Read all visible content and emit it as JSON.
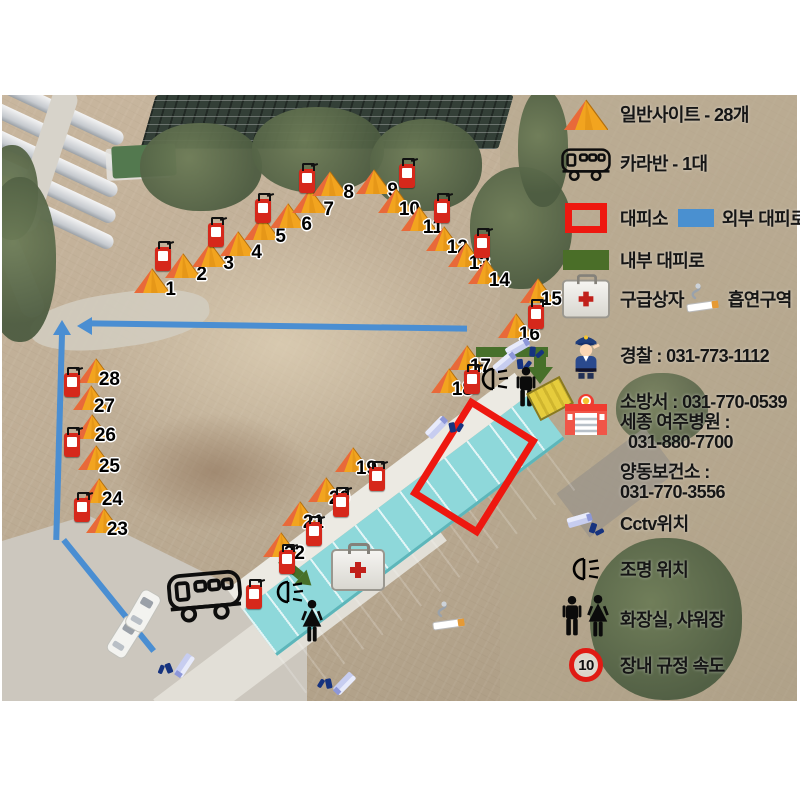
{
  "legend": {
    "site_label": "일반사이트 - 28개",
    "caravan_label": "카라반 - 1대",
    "shelter_label": "대피소",
    "external_route_label": "외부 대피로",
    "internal_route_label": "내부 대피로",
    "first_aid_label": "구급상자",
    "smoking_label": "흡연구역",
    "police_phone_label": "경찰 : 031-773-1112",
    "fire_phone_label": "소방서 : 031-770-0539",
    "hospital_name_label": "세종 여주병원 :",
    "hospital_phone": "031-880-7700",
    "health_center_label": "양동보건소 :",
    "health_center_phone": "031-770-3556",
    "cctv_label": "Cctv위치",
    "light_label": "조명 위치",
    "restroom_label": "화장실, 샤워장",
    "speed_label": "장내 규정 속도",
    "speed_value": "10"
  },
  "colors": {
    "external_route": "#4a8ed2",
    "internal_route": "#47702a",
    "shelter_outline": "#ee1810",
    "tent_body": "#f2a41f",
    "tent_flap": "#e8693a",
    "extinguisher": "#d6281b",
    "building_roof": "#8ed8da",
    "speed_circle": "#e01b14"
  },
  "map": {
    "tents": [
      {
        "n": "1",
        "x": 152,
        "y": 281
      },
      {
        "n": "2",
        "x": 183,
        "y": 266
      },
      {
        "n": "3",
        "x": 210,
        "y": 255
      },
      {
        "n": "4",
        "x": 238,
        "y": 244
      },
      {
        "n": "5",
        "x": 262,
        "y": 228
      },
      {
        "n": "6",
        "x": 288,
        "y": 216
      },
      {
        "n": "7",
        "x": 310,
        "y": 201
      },
      {
        "n": "8",
        "x": 330,
        "y": 184
      },
      {
        "n": "9",
        "x": 374,
        "y": 182
      },
      {
        "n": "10",
        "x": 396,
        "y": 201
      },
      {
        "n": "11",
        "x": 419,
        "y": 219
      },
      {
        "n": "12",
        "x": 444,
        "y": 239
      },
      {
        "n": "13",
        "x": 466,
        "y": 255
      },
      {
        "n": "14",
        "x": 486,
        "y": 272
      },
      {
        "n": "15",
        "x": 538,
        "y": 291
      },
      {
        "n": "16",
        "x": 516,
        "y": 326
      },
      {
        "n": "17",
        "x": 467,
        "y": 358
      },
      {
        "n": "18",
        "x": 449,
        "y": 381
      },
      {
        "n": "19",
        "x": 353,
        "y": 460
      },
      {
        "n": "20",
        "x": 326,
        "y": 490
      },
      {
        "n": "21",
        "x": 300,
        "y": 514
      },
      {
        "n": "22",
        "x": 281,
        "y": 545
      },
      {
        "n": "23",
        "x": 104,
        "y": 521
      },
      {
        "n": "24",
        "x": 99,
        "y": 491
      },
      {
        "n": "25",
        "x": 96,
        "y": 458
      },
      {
        "n": "26",
        "x": 92,
        "y": 427
      },
      {
        "n": "27",
        "x": 91,
        "y": 398
      },
      {
        "n": "28",
        "x": 96,
        "y": 371
      }
    ],
    "extinguishers": [
      {
        "x": 163,
        "y": 259
      },
      {
        "x": 216,
        "y": 235
      },
      {
        "x": 263,
        "y": 211
      },
      {
        "x": 307,
        "y": 181
      },
      {
        "x": 407,
        "y": 176
      },
      {
        "x": 442,
        "y": 211
      },
      {
        "x": 482,
        "y": 246
      },
      {
        "x": 536,
        "y": 317
      },
      {
        "x": 472,
        "y": 382
      },
      {
        "x": 377,
        "y": 479
      },
      {
        "x": 341,
        "y": 505
      },
      {
        "x": 314,
        "y": 534
      },
      {
        "x": 287,
        "y": 562
      },
      {
        "x": 254,
        "y": 597
      },
      {
        "x": 72,
        "y": 385
      },
      {
        "x": 72,
        "y": 445
      },
      {
        "x": 82,
        "y": 510
      }
    ],
    "cctv": [
      {
        "x": 518,
        "y": 347,
        "r": -14
      },
      {
        "x": 505,
        "y": 362,
        "r": -24
      },
      {
        "x": 437,
        "y": 427,
        "r": -30
      },
      {
        "x": 344,
        "y": 684,
        "r": 150
      },
      {
        "x": 184,
        "y": 666,
        "r": 140
      }
    ],
    "lights": [
      {
        "x": 495,
        "y": 379
      },
      {
        "x": 290,
        "y": 592
      }
    ],
    "men_restroom": {
      "x": 526,
      "y": 387
    },
    "women_restroom": {
      "x": 312,
      "y": 621
    },
    "caravan": {
      "x": 205,
      "y": 594
    },
    "first_aid": {
      "x": 356,
      "y": 568
    },
    "smoking": {
      "x": 452,
      "y": 617
    },
    "waste_box": {
      "x": 548,
      "y": 397
    },
    "cars": [
      {
        "x": 124,
        "y": 636,
        "r": 32
      },
      {
        "x": 142,
        "y": 610,
        "r": 30
      }
    ]
  }
}
